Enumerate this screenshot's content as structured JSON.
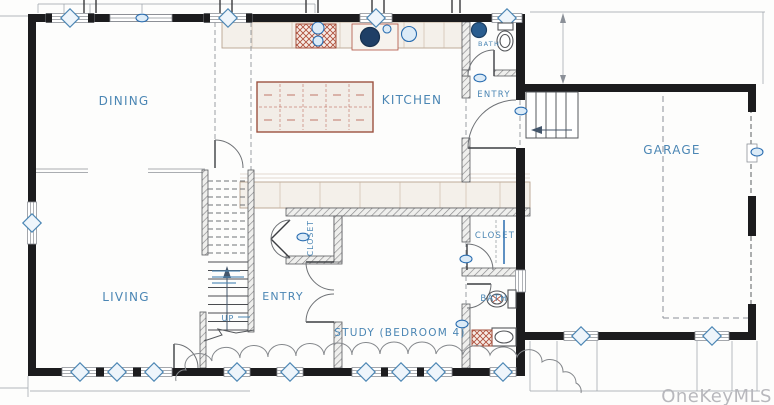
{
  "watermark": "OneKeyMLS",
  "rooms": {
    "dining": "DINING",
    "kitchen": "KITCHEN",
    "bath_top": "BATH",
    "entry_side": "ENTRY",
    "garage": "GARAGE",
    "living": "LIVING",
    "entry_main": "ENTRY",
    "closet_hall": "CLOSET",
    "closet_right": "CLOSET",
    "bath_lower": "BATH",
    "study": "STUDY (BEDROOM 4)"
  },
  "stairs": {
    "direction_label": "UP"
  },
  "colors": {
    "wall": "#1c1c1e",
    "label_blue": "#4b86b4",
    "cabinet_brown": "#9c5240",
    "appliance_red": "#b0503c",
    "fixture_blue": "#2a6db0",
    "watermark_gray": "#b5b5ba"
  }
}
